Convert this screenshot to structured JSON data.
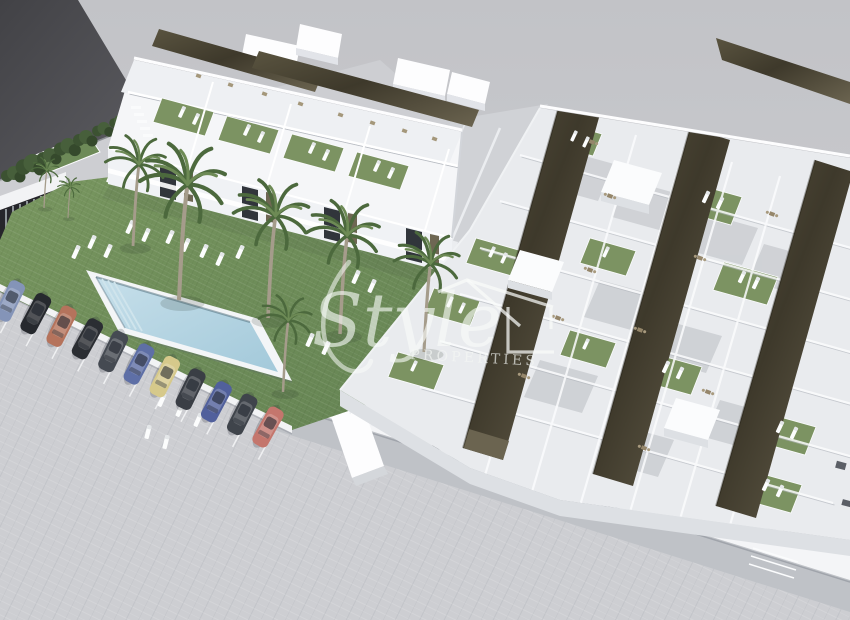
{
  "meta": {
    "description": "Aerial 3D architectural render of a new-build residential development: white townhouses and an apartment block with dark bronze pergola roof terraces, artificial-turf solariums with sun loungers, a communal lawn garden with palm trees, a rectangular swimming pool, and a street-side parking row with eleven cars."
  },
  "watermark": {
    "script": "Style",
    "caps": "PROPERTIES",
    "icon": "house-outline-icon"
  },
  "scene": {
    "car_count": 11,
    "townhouse_units": 4,
    "pergola_strips": 3,
    "regions": [
      "street",
      "parking-row",
      "communal-garden",
      "swimming-pool",
      "townhouse-row",
      "apartment-block",
      "perimeter-path"
    ]
  },
  "palette": {
    "sky_top": "#c2c3c7",
    "sky_bottom": "#d2d3d6",
    "ground": "#cdced2",
    "road_dark": "#424246",
    "road_light": "#5d5d62",
    "lawn": "#6d8c58",
    "turf": "#7c9362",
    "pergola_dark": "#3e392b",
    "pergola_light": "#6b6450",
    "wall_white": "#f8f9fb",
    "wall_shade": "#dde0e4",
    "floor_gray": "#c7cace",
    "patio": "#ebedf0",
    "pool_deck": "#f3f5f7",
    "pool_water": "#b7d5e3",
    "pool_deep": "#a3c9da",
    "path_gray": "#bfc2c7",
    "hedge_green": "#41563a",
    "palm_frond": "#4c693d",
    "palm_trunk": "#a59c8b",
    "furniture_tan": "#95866a",
    "watermark_white": "rgba(249,251,249,0.62)",
    "car_colors": [
      "#8494b8",
      "#26292e",
      "#b5735c",
      "#2b2e33",
      "#454a52",
      "#5e6fa6",
      "#d6c98b",
      "#3a3e45",
      "#51609c",
      "#3f444b",
      "#c4766d"
    ]
  }
}
